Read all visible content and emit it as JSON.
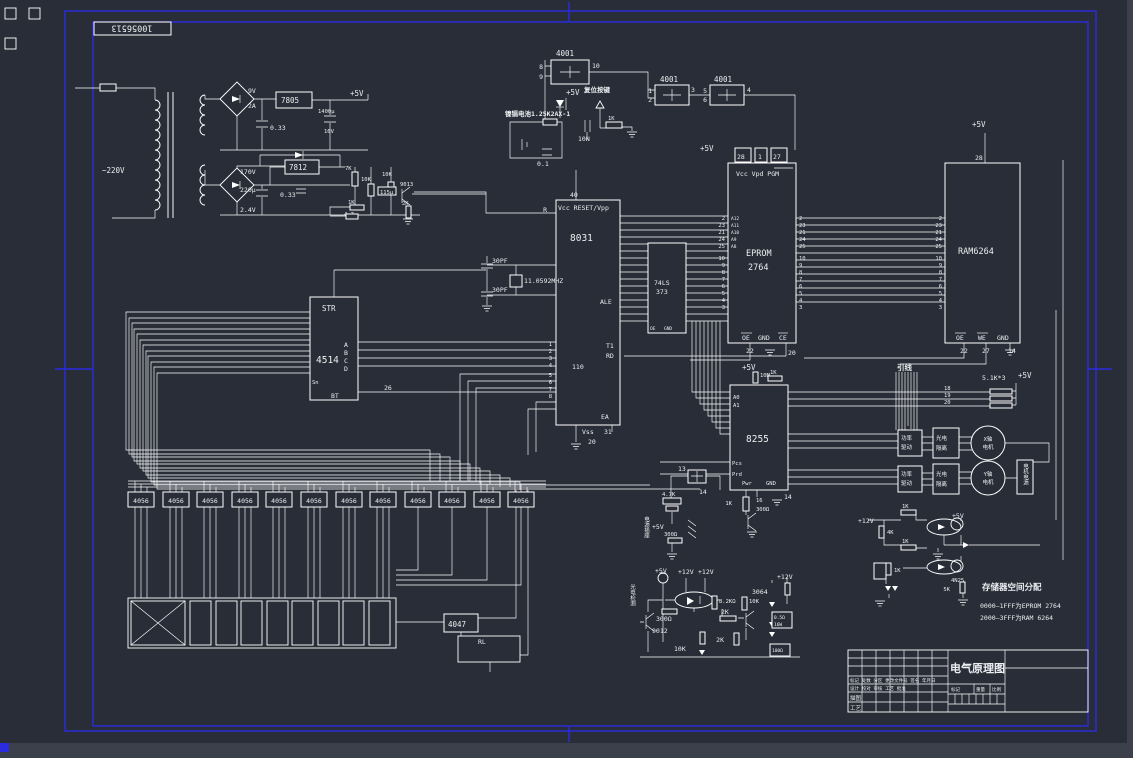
{
  "meta": {
    "bg": "#282d37",
    "wire": "#ffffff",
    "frame_blue": "#2b2be0"
  },
  "stamp": {
    "value": "10056513"
  },
  "power": {
    "mains": "~220V",
    "sec1_v": "9V",
    "sec1_a": "2A",
    "reg1": "7805",
    "cap_in1": "0.33",
    "cap_out1": "1400μ",
    "cap_out1_v": "16V",
    "rail": "+5V",
    "sec2_v": "170V",
    "cap_sec2": "220μ",
    "sec2_dc": "2.4V",
    "reg2": "7812",
    "cap_in2": "0.33",
    "r7k": "7K",
    "r10k_a": "10K",
    "r10k_b": "10K",
    "c115": "115μ",
    "r1k": "1K",
    "r47": "4.7",
    "r2k": "2K",
    "q1": "9013"
  },
  "reset": {
    "gate": "4001",
    "g1_in1": "8",
    "g1_in2": "9",
    "g1_out": "10",
    "g2_in1": "1",
    "g2_in2": "2",
    "g2_out": "3",
    "g3_in1": "5",
    "g3_in2": "6",
    "g3_out": "4",
    "rail": "+5V",
    "battery": "镍镉电池1.25K2AX-1",
    "cap1": "0.1",
    "cap2": "10N",
    "r1": "1K",
    "key": "复位按键"
  },
  "cpu": {
    "pin_vcc": "40",
    "top_label": "Vcc RESET/Vpp",
    "name": "8031",
    "reset_net": "R",
    "cap1": "30PF",
    "cap2": "30PF",
    "xtal": "11.0592MHZ",
    "ale": "ALE",
    "t1": "T1",
    "rd": "RD",
    "net110": "110",
    "ea": "EA",
    "ea_pin": "31",
    "vss": "Vss",
    "vss_pin": "20",
    "p1_pins": [
      "1",
      "2",
      "3",
      "4",
      "5",
      "6",
      "7",
      "8"
    ]
  },
  "latch": {
    "name1": "74LS",
    "name2": "373",
    "oe": "OE",
    "gnd": "GND"
  },
  "eprom": {
    "rail": "+5V",
    "pin28": "28",
    "pin1": "1",
    "pin27": "27",
    "hdr": "Vcc Vpd PGM",
    "name1": "EPROM",
    "name2": "2764",
    "left_pins": [
      "2",
      "23",
      "21",
      "24",
      "25"
    ],
    "addr_hi": [
      "A12",
      "A11",
      "A10",
      "A9",
      "A8"
    ],
    "left_pins2": [
      "10",
      "9",
      "8",
      "7",
      "6",
      "5",
      "4",
      "3"
    ],
    "right_pins": [
      "2",
      "23",
      "21",
      "24",
      "25"
    ],
    "right_pins2": [
      "10",
      "9",
      "8",
      "7",
      "6",
      "5",
      "4",
      "3"
    ],
    "oe": "OE",
    "oe_pin": "22",
    "gnd": "GND",
    "ce": "CE",
    "ce_pin": "20"
  },
  "ram": {
    "rail": "+5V",
    "pin28": "28",
    "name": "RAM6264",
    "left_pins": [
      "2",
      "23",
      "21",
      "24",
      "25"
    ],
    "left_pins2": [
      "10",
      "9",
      "8",
      "7",
      "6",
      "5",
      "4",
      "3"
    ],
    "oe": "OE",
    "oe_pin": "22",
    "we": "WE",
    "we_pin": "27",
    "gnd": "GND",
    "gnd_pin": "14"
  },
  "pio": {
    "rail": "+5V",
    "r_pull": "10M",
    "r1": "1K",
    "a0": "A0",
    "a1": "A1",
    "name": "8255",
    "pcs": "Pcs",
    "prd": "Prd",
    "pwr": "Pwr",
    "gnd": "GND",
    "gnd_pin": "14",
    "pin16": "16",
    "r2": "1K",
    "r3": "300Ω"
  },
  "buzzer": {
    "pin13": "13",
    "pin14": "14",
    "r1": "4.7K",
    "rail": "+5V",
    "r2": "300Ω",
    "conn": "电源插座"
  },
  "decoder": {
    "str": "STR",
    "name": "4514",
    "a": "A",
    "b": "B",
    "c": "C",
    "d": "D",
    "bt": "BT",
    "sn": "Sn",
    "bus": "26"
  },
  "drivers": {
    "chips": [
      "4056",
      "4056",
      "4056",
      "4056",
      "4056",
      "4056",
      "4056",
      "4056",
      "4056",
      "4056",
      "4056",
      "4056"
    ]
  },
  "lower": {
    "u1": "4047",
    "rl": "RL"
  },
  "harness": {
    "label": "引线",
    "w18": "18",
    "w19": "19",
    "w20": "20",
    "rnet": "5.1K*3",
    "rail": "+5V"
  },
  "motion": {
    "amp1": "功率",
    "amp2": "驱动",
    "iso1": "光电",
    "iso2": "隔离",
    "m1a": "X轴",
    "m1b": "电机",
    "m2a": "Y轴",
    "m2b": "电机",
    "psu": "电机电源"
  },
  "sense": {
    "rail5": "+5V",
    "rail12a": "+12V",
    "rail12b": "+12V",
    "rail12c": "+12V",
    "r300": "300Ω",
    "q1": "9012",
    "r10k_a": "10K",
    "r10k_b": "10K",
    "r82": "8.2KΩ",
    "r2k_a": "2K",
    "r2k_b": "2K",
    "q2": "3064",
    "rs1": "0.5Ω",
    "rs1w": "16W",
    "rs2": "100Ω",
    "vtext": "光电检测"
  },
  "iso": {
    "rail12": "+12V",
    "r1": "1K",
    "r2": "4K",
    "r3": "1K",
    "r4": "1K",
    "opto": "4N25",
    "r5": "5K",
    "rail5": "+5V"
  },
  "memo": {
    "title": "存储器空间分配",
    "line1": "0000—1FFF为EPROM 2764",
    "line2": "2000—3FFF为RAM 6264"
  },
  "titleblock": {
    "title": "电气原理图",
    "row1": "标记 处数 分区 更改文件号 签名 年月日",
    "row2": "设计 校对 审核 工艺 批准",
    "c1": "标记",
    "c2": "重量",
    "c3": "比例",
    "l1": "描图",
    "l2": "工艺"
  }
}
